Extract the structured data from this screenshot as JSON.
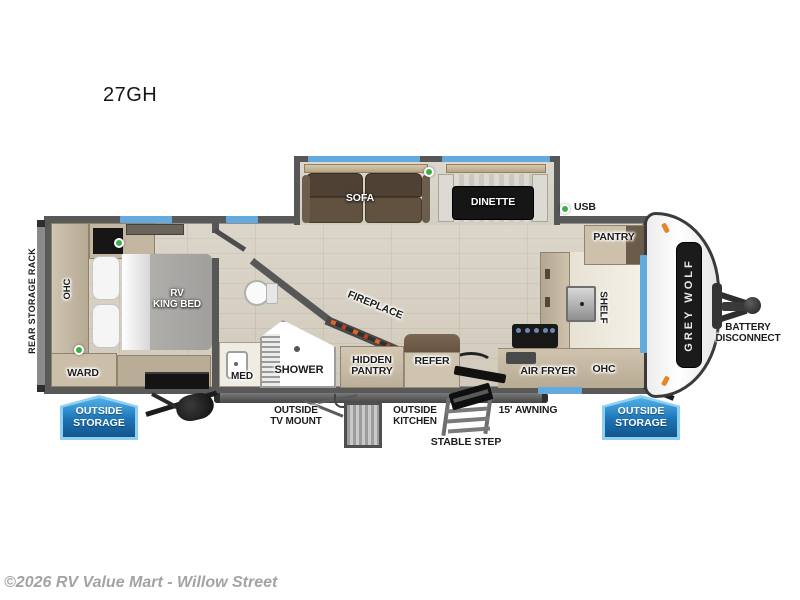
{
  "title": "27GH",
  "watermark": "©2026 RV Value Mart - Willow Street",
  "brand": "GREY WOLF",
  "colors": {
    "wall": "#595959",
    "floor": "#d6d0c4",
    "window_blue": "#64aadf",
    "indicator_green": "#3cae4b",
    "badge_blue": "#1d73b5",
    "badge_border_blue": "#8fd0f2",
    "cabinet_tan": "#c0b49e",
    "sofa_brown": "#554839",
    "bed_gray": "#a7a5a2",
    "logo_panel": "#1b1b1b"
  },
  "labels": {
    "rear_storage_rack": "REAR STORAGE RACK",
    "ohc_bedroom": "OHC",
    "rv_king_bed": "RV\nKING BED",
    "ward": "WARD",
    "med": "MED",
    "shower": "SHOWER",
    "fireplace": "FIREPLACE",
    "hidden_pantry": "HIDDEN\nPANTRY",
    "refer": "REFER",
    "sofa": "SOFA",
    "dinette": "DINETTE",
    "usb": "USB",
    "pantry": "PANTRY",
    "shelf": "SHELF",
    "air_fryer": "AIR FRYER",
    "ohc_kitchen": "OHC",
    "battery_disconnect": "BATTERY\nDISCONNECT",
    "outside_storage_left": "OUTSIDE\nSTORAGE",
    "outside_storage_right": "OUTSIDE\nSTORAGE",
    "outside_tv_mount": "OUTSIDE\nTV MOUNT",
    "outside_kitchen": "OUTSIDE\nKITCHEN",
    "stable_step": "STABLE STEP",
    "awning": "15' AWNING"
  }
}
